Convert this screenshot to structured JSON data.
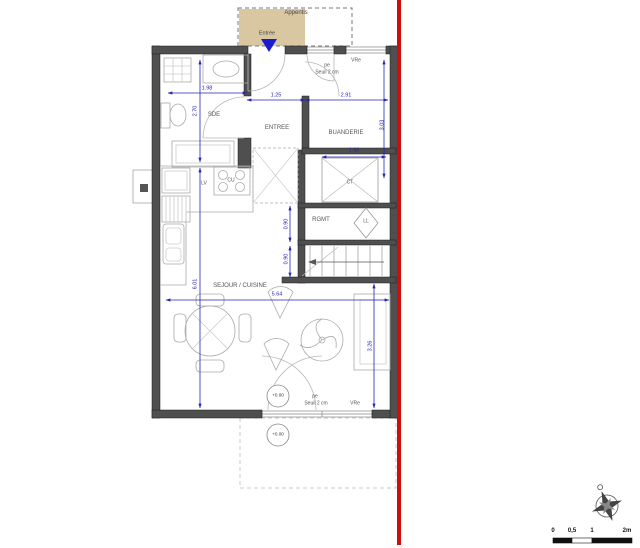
{
  "plan": {
    "appentis": {
      "label": "Appentis",
      "entree_label": "Entrée"
    },
    "rooms": {
      "sde": "SDE",
      "entree": "ENTREE",
      "buanderie": "BUANDERIE",
      "rgmt": "RGMT",
      "sejour": "SEJOUR / CUISINE"
    },
    "equipment": {
      "lv": "LV",
      "cu": "CU",
      "ct": "CT",
      "ll": "LL"
    },
    "openings": {
      "top": {
        "pe": "pe",
        "seuil": "Seuil 2 cm",
        "vr": "VRe"
      },
      "bottom": {
        "pe": "pe",
        "seuil": "Seuil 2 cm",
        "vr": "VRe"
      }
    },
    "levels": {
      "interior": "+0.00",
      "exterior": "+0.00"
    },
    "dimensions": {
      "top_left": "1.98",
      "top_mid": "1.25",
      "top_right": "2.91",
      "sde_height": "2.70",
      "buanderie_height": "3.03",
      "ct_width": "1.66",
      "stair_upper": "0.90",
      "stair_lower": "0.90",
      "sejour_width": "5.64",
      "sejour_height": "6.01",
      "terrace_side": "3.26"
    },
    "scale_bar": {
      "t0": "0",
      "t05": "0,5",
      "t1": "1",
      "t2": "2m"
    },
    "colors": {
      "wall": "#4f4f4f",
      "dimension_blue": "#2525b4",
      "boundary_red": "#d40b0b",
      "appentis_fill": "#d9c7a2"
    }
  }
}
